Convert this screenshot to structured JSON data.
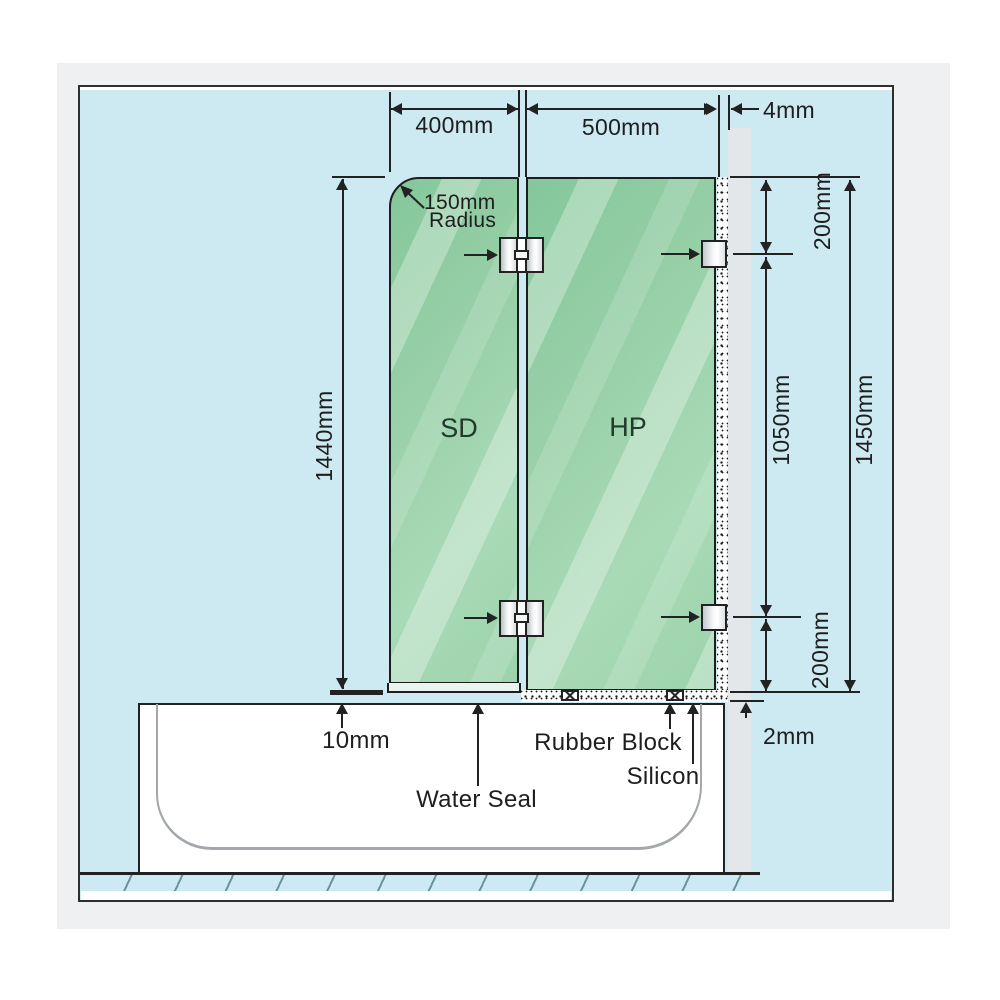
{
  "diagram": {
    "type": "shower-screen-installation-diagram",
    "panel_labels": {
      "shower_door": "SD",
      "hinge_panel": "HP"
    },
    "dimensions": {
      "door_width": "400mm",
      "panel_width": "500mm",
      "wall_gap": "4mm",
      "door_height": "1440mm",
      "hinge_top_offset": "200mm",
      "hinge_spacing": "1050mm",
      "panel_height": "1450mm",
      "hinge_bottom_offset": "200mm",
      "door_bottom_gap": "10mm",
      "silicon_thickness": "2mm"
    },
    "radius_note": {
      "value": "150mm",
      "word": "Radius"
    },
    "callouts": {
      "water_seal": "Water Seal",
      "rubber_block": "Rubber Block",
      "silicon": "Silicon"
    },
    "colors": {
      "canvas_blue": "#cde9f2",
      "glass_green": "#9ed3ae",
      "wall_gray": "#e3e7e9",
      "page_band": "#eef0f2",
      "line": "#222222"
    }
  }
}
